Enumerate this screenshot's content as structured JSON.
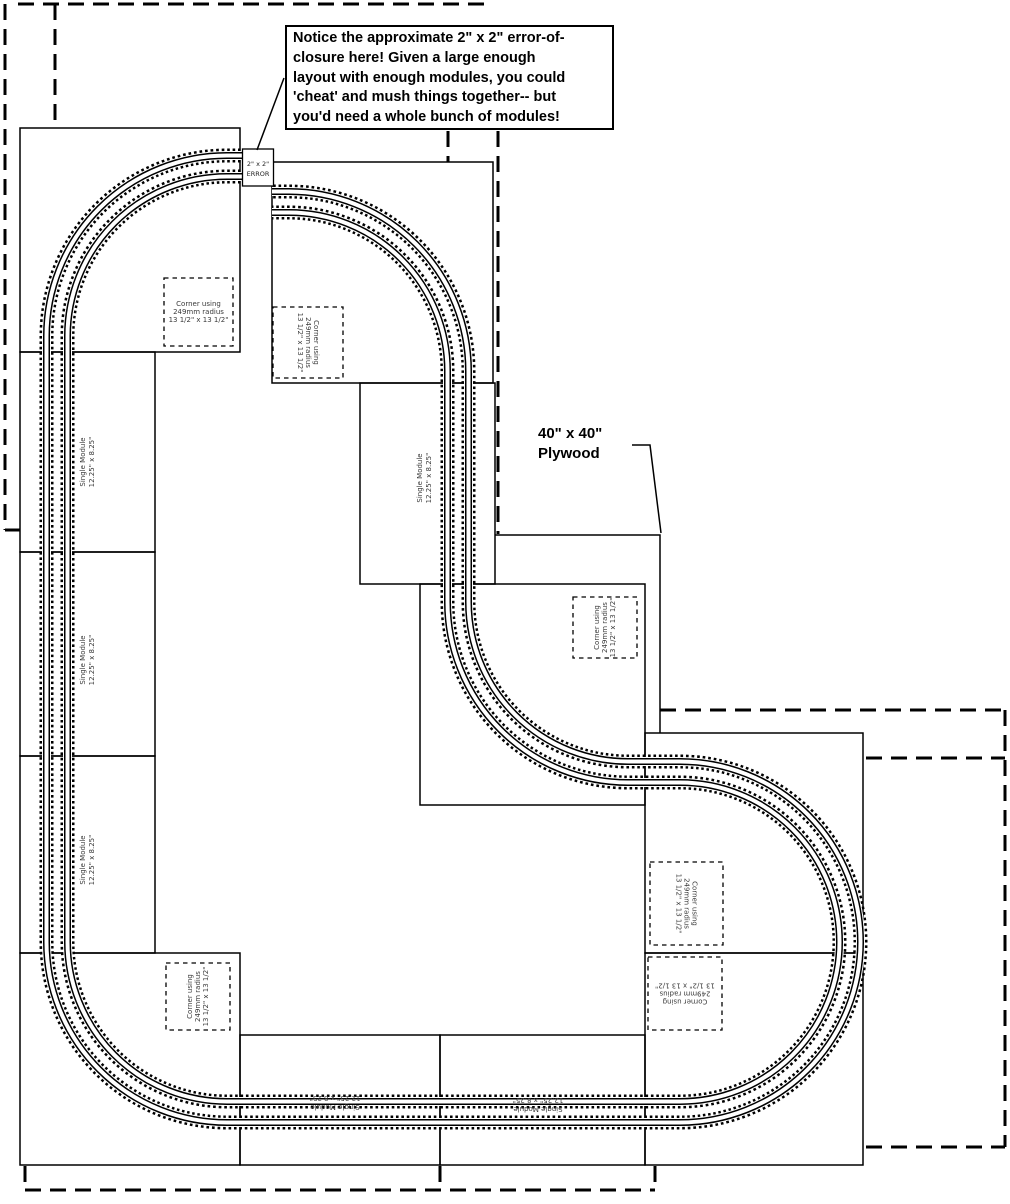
{
  "callout": {
    "line1": "Notice the approximate 2\" x 2\" error-of-",
    "line2": "closure here!  Given a large enough",
    "line3": "layout with enough modules, you could",
    "line4": "'cheat' and mush things together-- but",
    "line5": "you'd need a whole bunch of modules!"
  },
  "error_box": {
    "line1": "2\" x 2\"",
    "line2": "ERROR"
  },
  "plywood_label": {
    "line1": "40\" x 40\"",
    "line2": "Plywood"
  },
  "corner_label": {
    "line1": "Corner using",
    "line2": "249mm radius",
    "line3": "13 1/2\" x 13 1/2\""
  },
  "single_module_label": {
    "line1": "Single Module",
    "line2": "12.25\" x 8.25\""
  },
  "colors": {
    "ink": "#000000",
    "paper": "#ffffff",
    "fine_text": "#3a3a3a"
  }
}
